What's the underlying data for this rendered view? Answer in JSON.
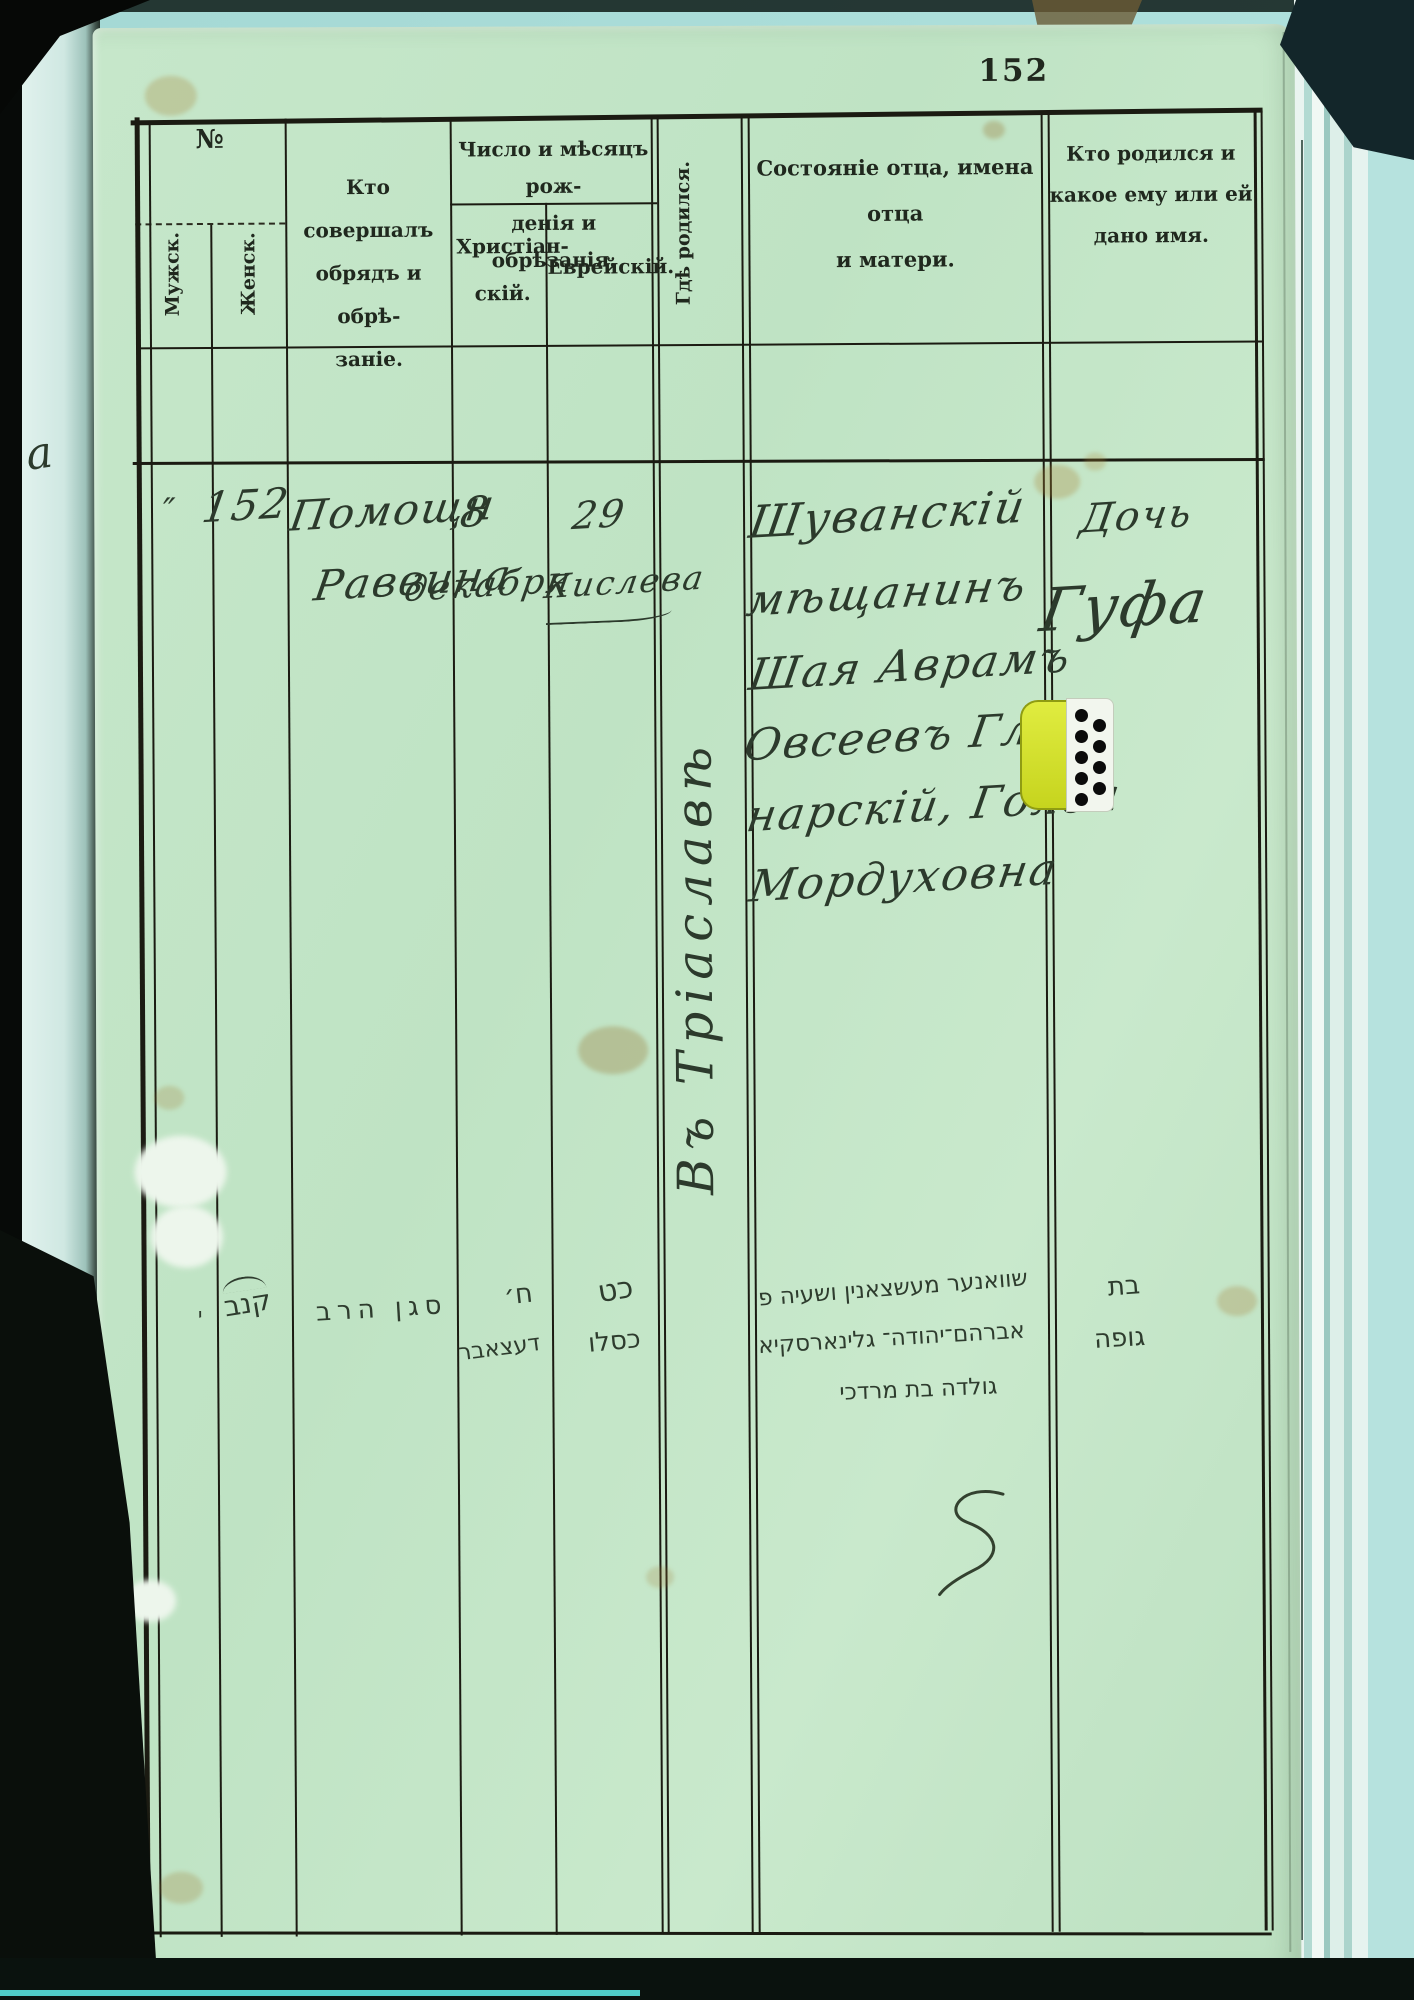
{
  "page": {
    "number_printed": "152",
    "margin_fragment": "а"
  },
  "header": {
    "no": "№",
    "male": "Мужск.",
    "female": "Женск.",
    "officiant": [
      "Кто совершалъ",
      "обрядъ и обрѣ-",
      "заніе."
    ],
    "dates": [
      "Число и мѣсяцъ рож-",
      "денія и обрѣзанія."
    ],
    "christian": [
      "Христіан-",
      "скій."
    ],
    "jewish": "Еврейскій.",
    "birthplace": "Гдѣ родился.",
    "father": [
      "Состояніе отца, имена отца",
      "и матери."
    ],
    "child": [
      "Кто родился и",
      "какое ему или ей",
      "дано имя."
    ]
  },
  "record": {
    "male_mark": "″",
    "number": "152",
    "officiant": [
      "Помощн",
      "Раввина"
    ],
    "christian_day": "8",
    "christian_month": "декабря",
    "jewish_day": "29",
    "jewish_month": "Кислева",
    "birthplace": "Въ Тріаславѣ",
    "father": [
      "Шуванскій",
      "мѣщанинъ",
      "Шая Аврамъ",
      "Овсеевъ Гли-",
      "нарскій, Голда",
      "Мордуховна"
    ],
    "child": [
      "Дочь",
      "Гуфа"
    ]
  },
  "hebrew": {
    "male_mark": "י",
    "number": "קנב",
    "officiant": "סגן הרב",
    "christian_day": "ח׳",
    "christian_month": "דעצאבר",
    "jewish_day": "כט",
    "jewish_month": "כסלו",
    "father": [
      "שוואנער מעשצאנין ושעיה פ",
      "אברהם־יהודה־ גלינארסקיא",
      "גולדה בת מרדכי"
    ],
    "child": [
      "בת",
      "גופה"
    ]
  },
  "colors": {
    "page": "#c4e6c8",
    "ink": "#2c3a2c",
    "print_ink": "#20281e",
    "table_line": "#1b1b12",
    "surround": "#a9dcd8",
    "tab": "#d6e432"
  }
}
